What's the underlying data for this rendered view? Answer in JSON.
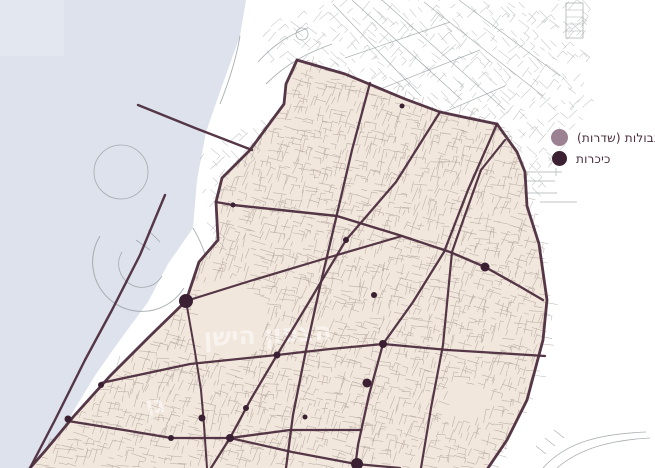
{
  "legend": {
    "items": [
      {
        "label": "גבולות (שדרות)",
        "color": "#9b8191",
        "type": "boundary"
      },
      {
        "label": "כיכרות",
        "color": "#3c2133",
        "type": "square"
      }
    ]
  },
  "map": {
    "width": 655,
    "height": 468,
    "colors": {
      "water": "#dde2ec",
      "water_light": "#e7ebf3",
      "land": "#ffffff",
      "district": "#f1e7dd",
      "boundary": "#4e2f40",
      "dot": "#3a2032",
      "street_beige": "#a5978d",
      "street_gray": "#979da0",
      "label": "#ffffff"
    },
    "water_polygon": [
      [
        0,
        0
      ],
      [
        246,
        0
      ],
      [
        240,
        36
      ],
      [
        222,
        86
      ],
      [
        206,
        132
      ],
      [
        197,
        180
      ],
      [
        193,
        228
      ],
      [
        168,
        264
      ],
      [
        148,
        302
      ],
      [
        120,
        340
      ],
      [
        96,
        374
      ],
      [
        74,
        410
      ],
      [
        58,
        446
      ],
      [
        52,
        468
      ],
      [
        0,
        468
      ]
    ],
    "water_light_rect": [
      0,
      0,
      64,
      56
    ],
    "district_polygon": [
      [
        297,
        60
      ],
      [
        345,
        74
      ],
      [
        405,
        99
      ],
      [
        440,
        112
      ],
      [
        468,
        118
      ],
      [
        497,
        124
      ],
      [
        517,
        152
      ],
      [
        525,
        172
      ],
      [
        527,
        206
      ],
      [
        539,
        244
      ],
      [
        547,
        300
      ],
      [
        543,
        340
      ],
      [
        527,
        400
      ],
      [
        507,
        440
      ],
      [
        488,
        468
      ],
      [
        30,
        468
      ],
      [
        45,
        451
      ],
      [
        74,
        416
      ],
      [
        110,
        376
      ],
      [
        150,
        336
      ],
      [
        186,
        301
      ],
      [
        199,
        262
      ],
      [
        218,
        240
      ],
      [
        216,
        202
      ],
      [
        222,
        178
      ],
      [
        250,
        150
      ],
      [
        284,
        104
      ],
      [
        286,
        84
      ]
    ],
    "boulevards": [
      {
        "name": "boundary-west-coast",
        "w": 2.8,
        "pts": [
          [
            297,
            60
          ],
          [
            286,
            84
          ],
          [
            284,
            104
          ],
          [
            250,
            150
          ],
          [
            222,
            178
          ],
          [
            216,
            202
          ],
          [
            218,
            240
          ],
          [
            199,
            262
          ],
          [
            186,
            301
          ],
          [
            150,
            336
          ],
          [
            110,
            376
          ],
          [
            74,
            416
          ],
          [
            45,
            451
          ],
          [
            30,
            468
          ]
        ]
      },
      {
        "name": "boundary-north",
        "w": 2.8,
        "pts": [
          [
            297,
            60
          ],
          [
            345,
            74
          ],
          [
            405,
            99
          ],
          [
            440,
            112
          ],
          [
            468,
            118
          ],
          [
            497,
            124
          ]
        ]
      },
      {
        "name": "boundary-east",
        "w": 2.8,
        "pts": [
          [
            497,
            124
          ],
          [
            517,
            152
          ],
          [
            525,
            172
          ],
          [
            527,
            206
          ],
          [
            539,
            244
          ],
          [
            547,
            300
          ],
          [
            543,
            340
          ],
          [
            527,
            400
          ],
          [
            507,
            440
          ],
          [
            488,
            468
          ]
        ]
      },
      {
        "name": "blvd-v1",
        "w": 2.3,
        "pts": [
          [
            370,
            83
          ],
          [
            352,
            150
          ],
          [
            337,
            214
          ],
          [
            321,
            282
          ],
          [
            306,
            350
          ],
          [
            293,
            415
          ],
          [
            286,
            468
          ]
        ]
      },
      {
        "name": "blvd-v2",
        "w": 2.3,
        "pts": [
          [
            440,
            112
          ],
          [
            396,
            182
          ],
          [
            346,
            240
          ],
          [
            309,
            302
          ],
          [
            277,
            355
          ],
          [
            251,
            399
          ],
          [
            230,
            438
          ],
          [
            211,
            468
          ]
        ]
      },
      {
        "name": "blvd-v3",
        "w": 2.3,
        "pts": [
          [
            497,
            124
          ],
          [
            468,
            190
          ],
          [
            444,
            252
          ],
          [
            413,
            302
          ],
          [
            383,
            344
          ],
          [
            369,
            395
          ],
          [
            358,
            445
          ],
          [
            355,
            468
          ]
        ]
      },
      {
        "name": "blvd-v4",
        "w": 2.2,
        "pts": [
          [
            505,
            140
          ],
          [
            481,
            170
          ],
          [
            465,
            215
          ],
          [
            452,
            252
          ],
          [
            443,
            345
          ],
          [
            431,
            408
          ],
          [
            421,
            468
          ]
        ]
      },
      {
        "name": "blvd-v0",
        "w": 2.0,
        "pts": [
          [
            186,
            301
          ],
          [
            195,
            352
          ],
          [
            201,
            390
          ],
          [
            204,
            425
          ],
          [
            207,
            468
          ]
        ]
      },
      {
        "name": "blvd-h0",
        "w": 2.4,
        "pts": [
          [
            138,
            105
          ],
          [
            195,
            128
          ],
          [
            252,
            150
          ]
        ]
      },
      {
        "name": "blvd-h1",
        "w": 2.4,
        "pts": [
          [
            216,
            202
          ],
          [
            233,
            205
          ],
          [
            290,
            211
          ],
          [
            337,
            216
          ],
          [
            402,
            236
          ],
          [
            450,
            252
          ],
          [
            485,
            267
          ],
          [
            519,
            286
          ],
          [
            543,
            300
          ]
        ]
      },
      {
        "name": "blvd-h2",
        "w": 2.2,
        "pts": [
          [
            186,
            301
          ],
          [
            250,
            281
          ],
          [
            320,
            260
          ],
          [
            402,
            236
          ]
        ]
      },
      {
        "name": "blvd-hm1",
        "w": 2.3,
        "pts": [
          [
            101,
            383
          ],
          [
            190,
            364
          ],
          [
            277,
            355
          ],
          [
            330,
            349
          ],
          [
            383,
            344
          ],
          [
            448,
            350
          ],
          [
            545,
            356
          ]
        ]
      },
      {
        "name": "blvd-hm2",
        "w": 2.3,
        "pts": [
          [
            68,
            421
          ],
          [
            130,
            431
          ],
          [
            171,
            438
          ],
          [
            230,
            438
          ],
          [
            290,
            430
          ],
          [
            361,
            430
          ]
        ]
      },
      {
        "name": "blvd-hm3",
        "w": 2.2,
        "pts": [
          [
            230,
            438
          ],
          [
            292,
            452
          ],
          [
            356,
            464
          ],
          [
            400,
            468
          ]
        ]
      },
      {
        "name": "blvd-beach",
        "w": 2.4,
        "pts": [
          [
            165,
            195
          ],
          [
            140,
            255
          ],
          [
            112,
            310
          ],
          [
            85,
            360
          ],
          [
            55,
            420
          ],
          [
            30,
            468
          ]
        ]
      }
    ],
    "squares": [
      {
        "x": 186,
        "y": 301,
        "r": 7
      },
      {
        "x": 357,
        "y": 464,
        "r": 6
      },
      {
        "x": 233,
        "y": 205,
        "r": 2.5
      },
      {
        "x": 346,
        "y": 240,
        "r": 3
      },
      {
        "x": 402,
        "y": 106,
        "r": 2.5
      },
      {
        "x": 485,
        "y": 267,
        "r": 4.5
      },
      {
        "x": 374,
        "y": 295,
        "r": 3
      },
      {
        "x": 383,
        "y": 344,
        "r": 4
      },
      {
        "x": 277,
        "y": 355,
        "r": 3.5
      },
      {
        "x": 367,
        "y": 383,
        "r": 4.5
      },
      {
        "x": 246,
        "y": 408,
        "r": 3
      },
      {
        "x": 202,
        "y": 418,
        "r": 3.5
      },
      {
        "x": 230,
        "y": 438,
        "r": 4
      },
      {
        "x": 171,
        "y": 438,
        "r": 3
      },
      {
        "x": 101,
        "y": 385,
        "r": 3
      },
      {
        "x": 68,
        "y": 419,
        "r": 3.5
      },
      {
        "x": 305,
        "y": 417,
        "r": 2.5
      }
    ],
    "labels": [
      {
        "text": "הצפון הישן",
        "x": 268,
        "y": 343,
        "size": 25,
        "rot": -3,
        "op": 0.5
      },
      {
        "text": "גן",
        "x": 156,
        "y": 413,
        "size": 24,
        "rot": -8,
        "op": 0.5
      }
    ],
    "white_zones": [
      [
        [
          250,
          34
        ],
        [
          330,
          0
        ],
        [
          585,
          0
        ],
        [
          585,
          60
        ],
        [
          470,
          150
        ],
        [
          388,
          152
        ],
        [
          300,
          96
        ]
      ],
      [
        [
          198,
          152
        ],
        [
          282,
          106
        ],
        [
          288,
          152
        ],
        [
          240,
          252
        ],
        [
          206,
          242
        ]
      ],
      [
        [
          500,
          128
        ],
        [
          565,
          62
        ],
        [
          590,
          100
        ],
        [
          540,
          195
        ],
        [
          515,
          185
        ]
      ]
    ],
    "texture_exclusions": [
      [
        225,
        322,
        40
      ],
      [
        465,
        405,
        22
      ]
    ],
    "decor_paths": [
      {
        "d": "M566,3 h17 v35 h-17 Z",
        "w": 0.8
      },
      {
        "d": "M566,10 h17 M566,17 h17 M566,24 h17 M566,31 h17",
        "w": 0.5
      },
      {
        "d": "M505,172 H562 M505,181 H555 M522,193 H557 M540,202 H577 M556,168 V176",
        "w": 0.7
      },
      {
        "d": "M258,62 C276,42 292,34 308,28 M266,84 C288,62 310,52 332,44",
        "w": 0.9
      },
      {
        "d": "M296,34 a6,6 0 1 1 12,0 a6,6 0 1 1 -12,0",
        "w": 0.8
      },
      {
        "d": "M333,4 L421,96 M352,0 L462,100 M382,0 L505,110 M424,2 L543,96 M459,0 L560,76",
        "w": 0.7
      },
      {
        "d": "M345,58 L450,22 M365,95 L480,50 M398,132 L505,86",
        "w": 0.7
      },
      {
        "d": "M543,468 C566,442 600,434 646,432 M557,468 C580,448 612,440 650,438",
        "w": 0.8
      },
      {
        "d": "M536,446 l10,8 M545,438 l10,8 M554,430 l10,8",
        "w": 0.7
      },
      {
        "d": "M100,236 A47,47 0 1 0 184,288",
        "w": 1.0
      },
      {
        "d": "M122,252 A22,22 0 1 0 162,276",
        "w": 0.8
      },
      {
        "d": "M94,172 a27,27 0 1 1 54,0 a27,27 0 1 1 -54,0",
        "w": 0.8
      },
      {
        "d": "M136,240 l14,10 M148,230 l12,12",
        "w": 0.8
      },
      {
        "d": "M240,36 C236,60 228,84 220,104",
        "w": 0.9
      },
      {
        "d": "M193,228 C200,240 205,252 207,262",
        "w": 0.9
      }
    ],
    "texture": {
      "seed": 7,
      "beige_step": 8,
      "white_step": 10
    }
  }
}
